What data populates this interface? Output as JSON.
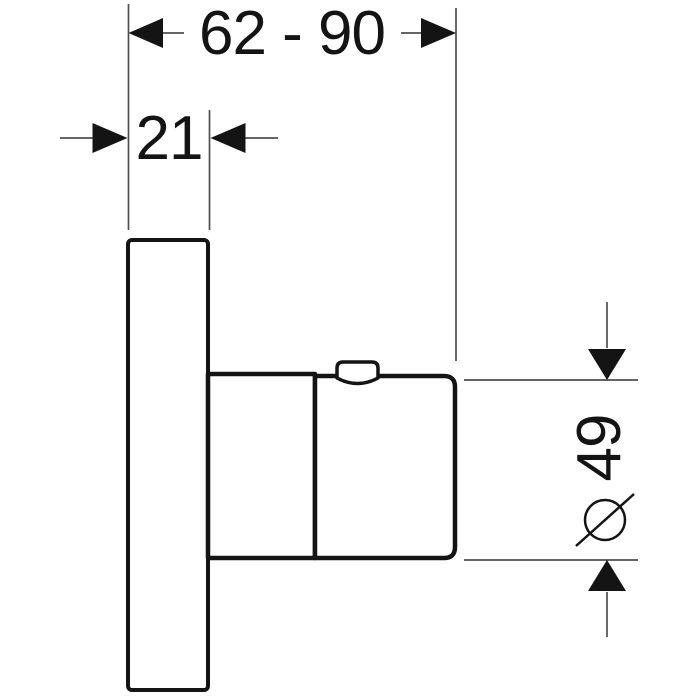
{
  "theme": {
    "bg": "#ffffff",
    "line": "#141414",
    "thin-line": "#4f4f4f",
    "text": "#141414"
  },
  "labels": {
    "width_range": "62 - 90",
    "plate_depth": "21",
    "diameter_value": "49",
    "diameter_symbol": "⌀"
  }
}
